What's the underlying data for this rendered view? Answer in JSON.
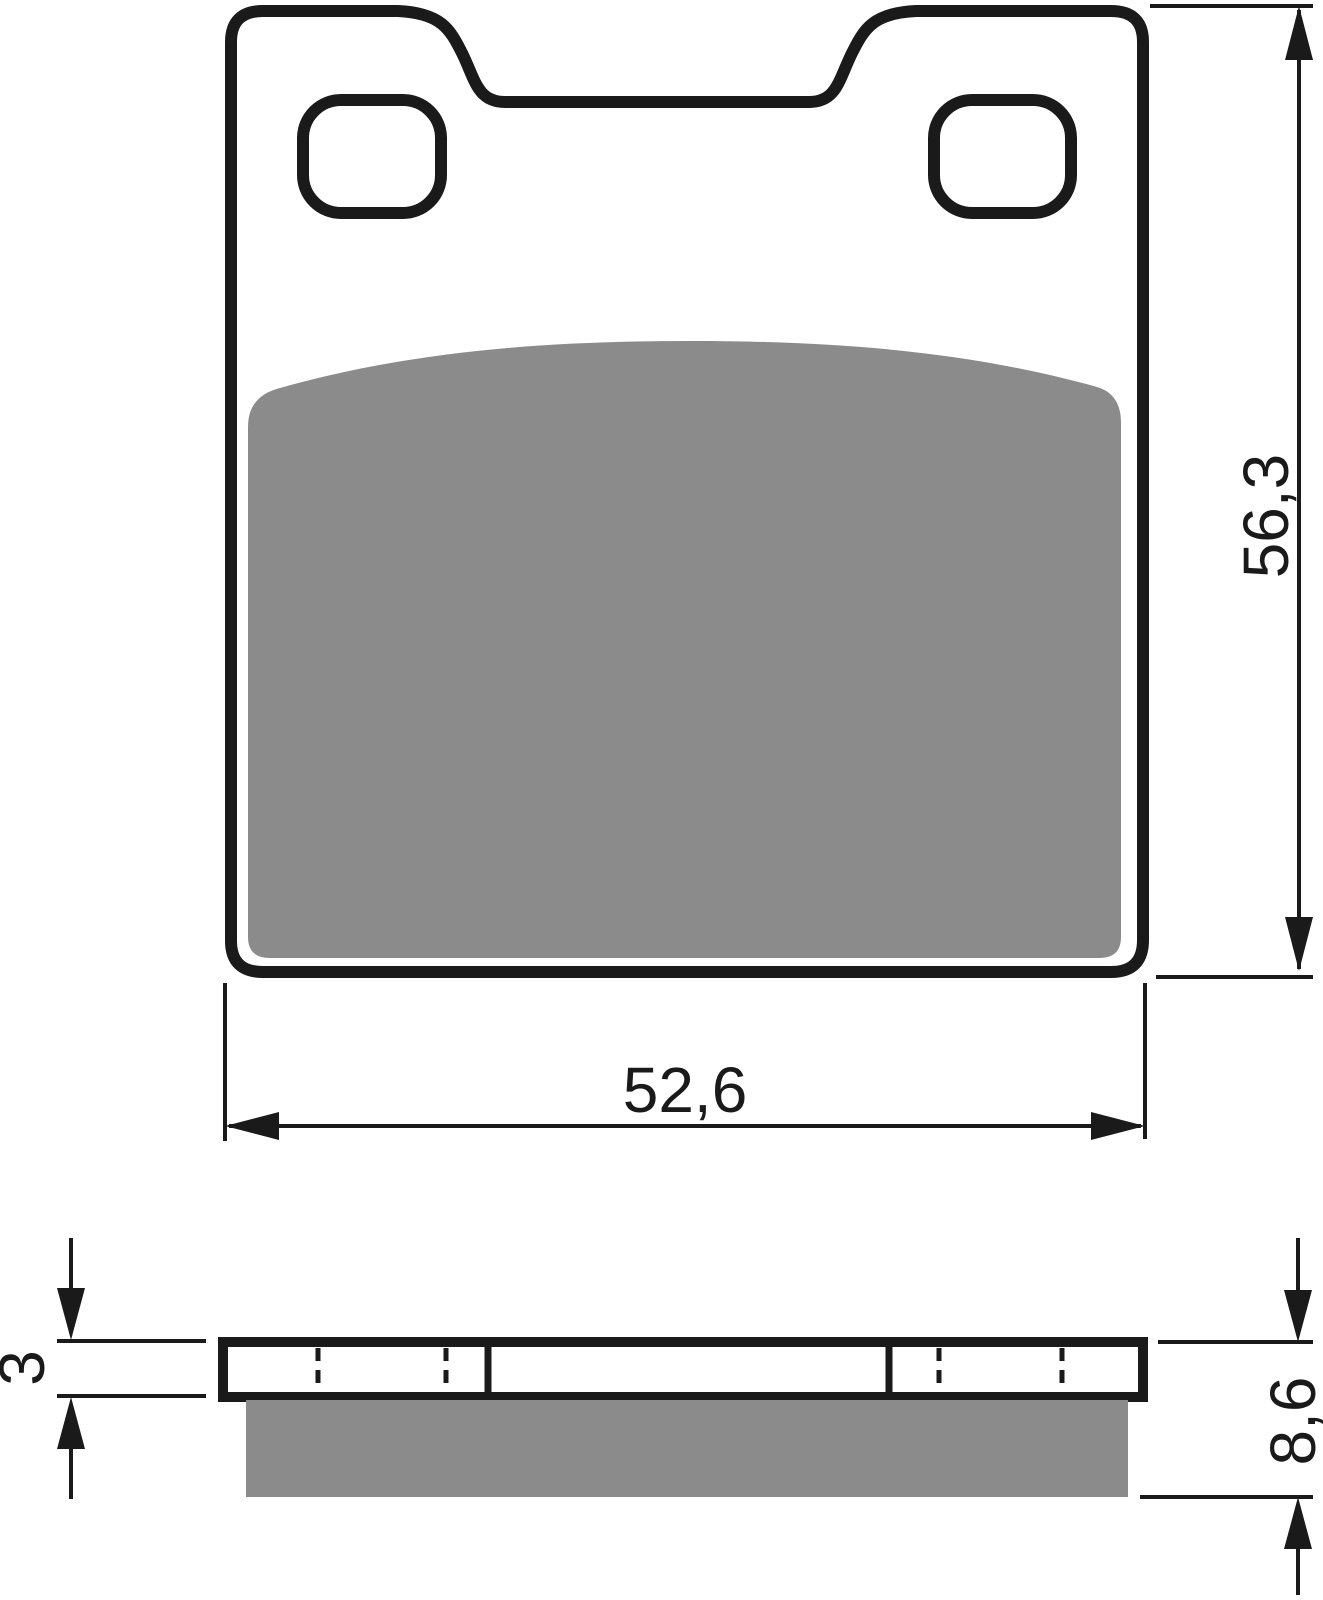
{
  "diagram": {
    "dimensions": {
      "width": {
        "value": "52,6"
      },
      "height": {
        "value": "56,3"
      },
      "plate_thickness": {
        "value": "3"
      },
      "total_thickness": {
        "value": "8,6"
      }
    },
    "colors": {
      "line": "#1a1a1a",
      "friction": "#8b8b8b",
      "background": "#ffffff"
    }
  }
}
